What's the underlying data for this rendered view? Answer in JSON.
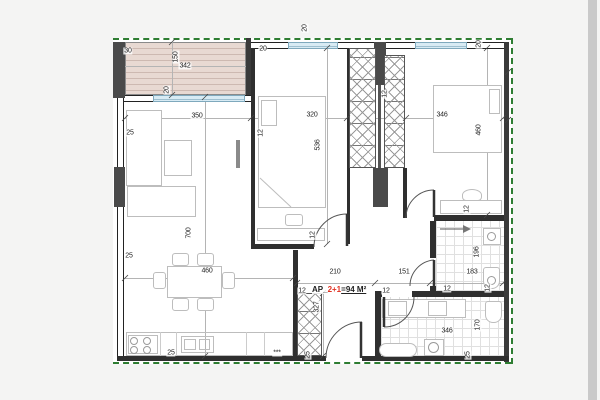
{
  "page": {
    "background": "#f4f4f3",
    "edge_strip_color": "#c9c9c9"
  },
  "plan": {
    "apartment": {
      "prefix": "AP_",
      "unit": "2+1",
      "area_suffix": "=94 M²"
    },
    "colors": {
      "wall": "#2f2f2f",
      "poche": "#4a4a4a",
      "insulation_green": "#2e7d32",
      "window_blue": "#d8ebf4",
      "terrace_fill": "#e8d9d2",
      "terrace_stripe": "#cdb9b1",
      "unit_highlight_red": "#e03020",
      "dimension_text": "#222222"
    },
    "labels": [
      "30",
      "150",
      "342",
      "20",
      "350",
      "25",
      "12",
      "320",
      "536",
      "20",
      "20",
      "346",
      "460",
      "20",
      "12",
      "700",
      "25",
      "460",
      "12",
      "12",
      "210",
      "151",
      "12",
      "12",
      "327",
      "196",
      "183",
      "12",
      "12",
      "346",
      "170",
      "25",
      "25",
      "25",
      "***"
    ]
  }
}
